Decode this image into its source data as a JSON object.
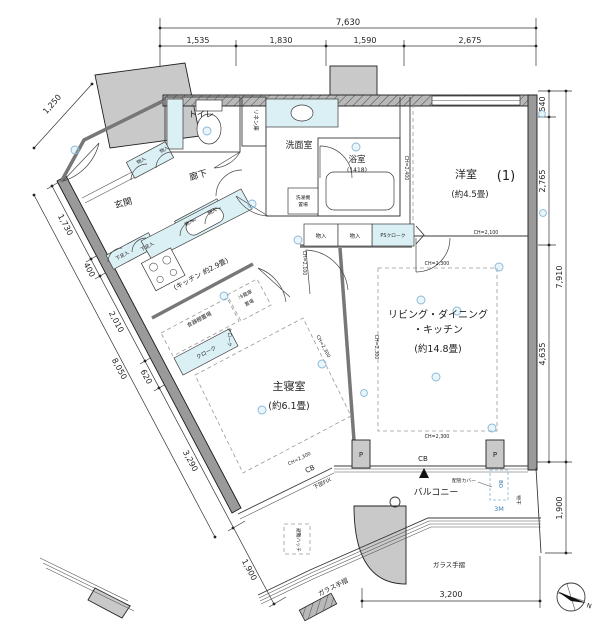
{
  "plan": {
    "rooms": {
      "entrance": "玄関",
      "hallway": "廊下",
      "toilet": "トイレ",
      "linen": "リネン庫",
      "washroom": "洗面室",
      "laundry1": "洗濯機",
      "laundry2": "置場",
      "bath": "浴室",
      "bath_size": "(1418)",
      "western": "洋室",
      "western_no": "(1)",
      "western_size": "(約4.5畳)",
      "kitchen": "(キッチン 約2.9畳)",
      "bedroom": "主寝室",
      "bedroom_size": "(約6.1畳)",
      "ldk1": "リビング・ダイニング",
      "ldk2": "・キッチン",
      "ldk_size": "(約14.8畳)",
      "balcony": "バルコニー"
    },
    "fixtures": {
      "storage": "物入",
      "shoe": "下足入",
      "cloak": "クローク",
      "ps_cloak": "PSクローク",
      "dish": "食器棚置場",
      "fridge1": "冷蔵庫",
      "fridge2": "置場",
      "pipe_cover": "配管カバー",
      "drying": "物干",
      "bo": "BO",
      "m3": "3M",
      "glass_rail": "ガラス手摺",
      "lower_fix": "下部FIX",
      "hatch": "避難ハッチ",
      "cb": "CB",
      "pillar": "P"
    },
    "ceiling": {
      "ch2100": "CH=2,100",
      "ch2300": "CH=2,300",
      "ch2400": "CH=2,400"
    },
    "dims": {
      "top_total": "7,630",
      "top": [
        "1,535",
        "1,830",
        "1,590",
        "2,675"
      ],
      "right": [
        "540",
        "2,765",
        "7,910",
        "4,635",
        "1,900"
      ],
      "left": [
        "1,250",
        "1,730",
        "400",
        "2,010",
        "8,050",
        "620",
        "3,290",
        "1,900"
      ],
      "bottom": "3,200"
    },
    "compass": {
      "north": "N"
    }
  }
}
